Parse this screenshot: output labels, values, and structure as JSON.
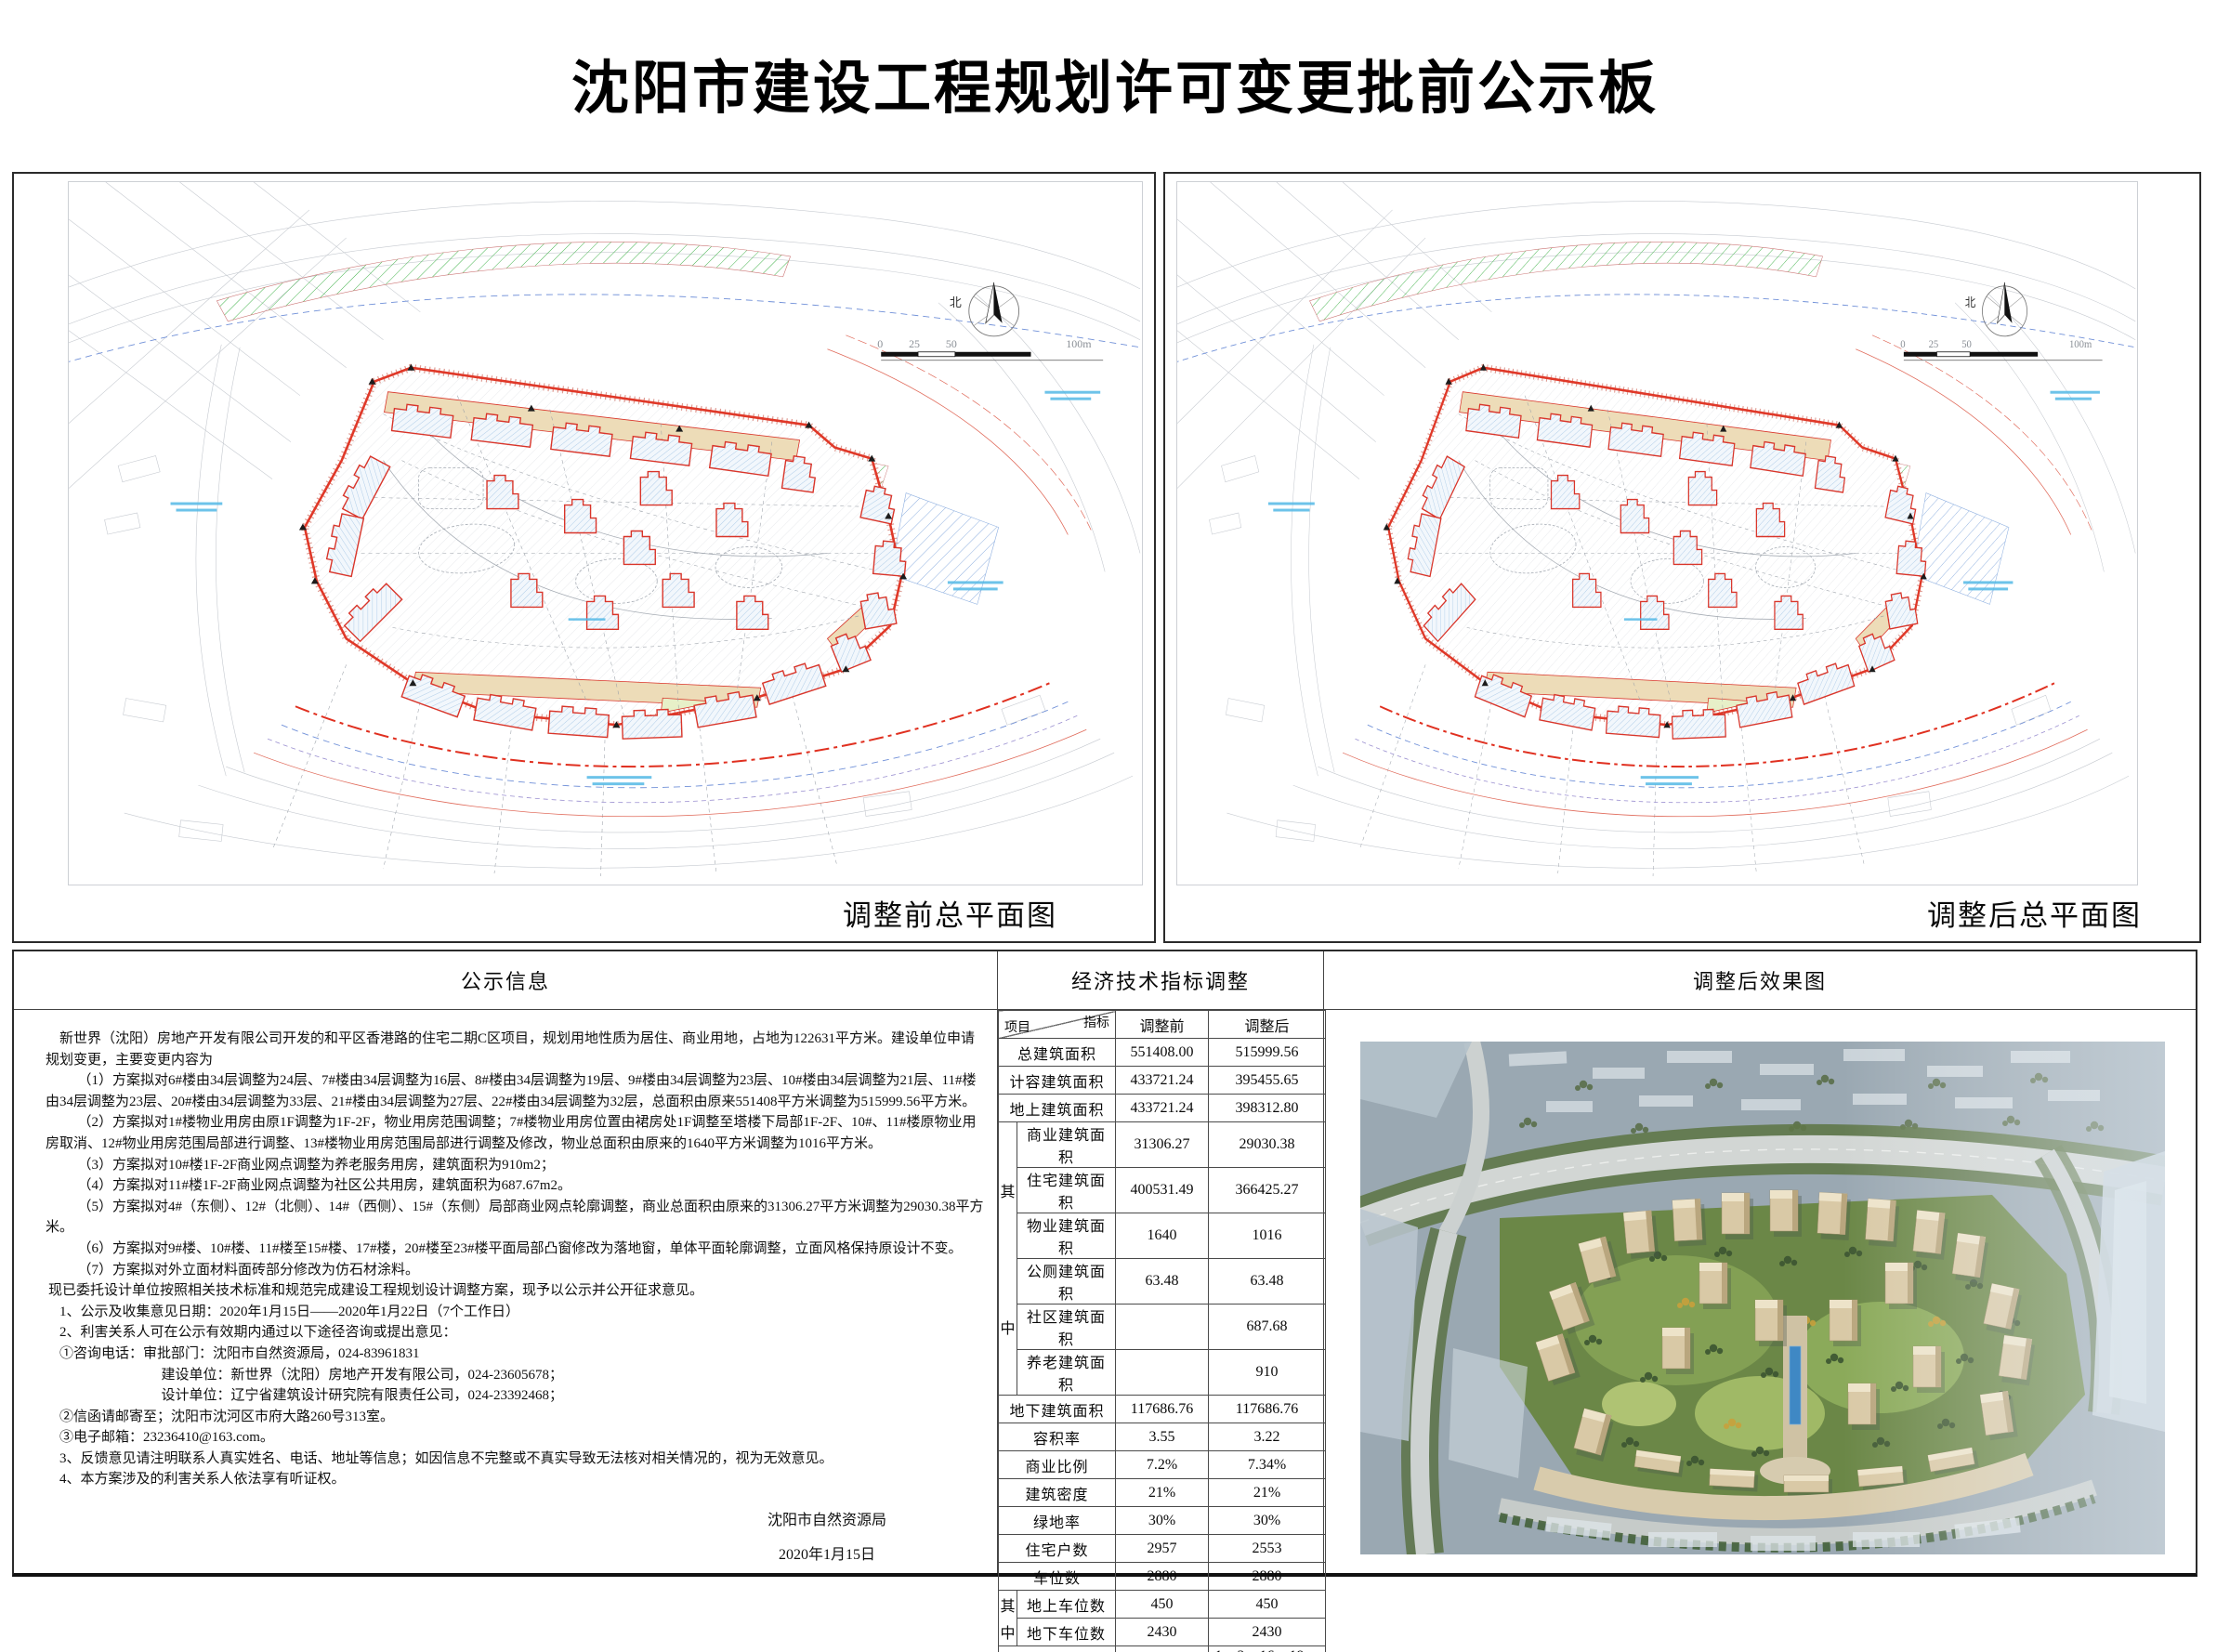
{
  "title": "沈阳市建设工程规划许可变更批前公示板",
  "plans": {
    "before_caption": "调整前总平面图",
    "after_caption": "调整后总平面图",
    "compass_label": "北",
    "scale": {
      "t0": "0",
      "t1": "25",
      "t2": "50",
      "t3": "100m"
    }
  },
  "sections": {
    "notice_header": "公示信息",
    "indicators_header": "经济技术指标调整",
    "render_header": "调整后效果图"
  },
  "notice": {
    "paragraphs": [
      "新世界（沈阳）房地产开发有限公司开发的和平区香港路的住宅二期C区项目，规划用地性质为居住、商业用地，占地为122631平方米。建设单位申请规划变更，主要变更内容为",
      "（1）方案拟对6#楼由34层调整为24层、7#楼由34层调整为16层、8#楼由34层调整为19层、9#楼由34层调整为23层、10#楼由34层调整为21层、11#楼由34层调整为23层、20#楼由34层调整为33层、21#楼由34层调整为27层、22#楼由34层调整为32层，总面积由原来551408平方米调整为515999.56平方米。",
      "（2）方案拟对1#楼物业用房由原1F调整为1F-2F，物业用房范围调整；7#楼物业用房位置由裙房处1F调整至塔楼下局部1F-2F、10#、11#楼原物业用房取消、12#物业用房范围局部进行调整、13#楼物业用房范围局部进行调整及修改，物业总面积由原来的1640平方米调整为1016平方米。",
      "（3）方案拟对10#楼1F-2F商业网点调整为养老服务用房，建筑面积为910m2；",
      "（4）方案拟对11#楼1F-2F商业网点调整为社区公共用房，建筑面积为687.67m2。",
      "（5）方案拟对4#（东侧）、12#（北侧）、14#（西侧）、15#（东侧）局部商业网点轮廓调整，商业总面积由原来的31306.27平方米调整为29030.38平方米。",
      "（6）方案拟对9#楼、10#楼、11#楼至15#楼、17#楼，20#楼至23#楼平面局部凸窗修改为落地窗，单体平面轮廓调整，立面风格保持原设计不变。",
      "（7）方案拟对外立面材料面砖部分修改为仿石材涂料。",
      "现已委托设计单位按照相关技术标准和规范完成建设工程规划设计调整方案，现予以公示并公开征求意见。",
      "1、公示及收集意见日期：2020年1月15日——2020年1月22日（7个工作日）",
      "2、利害关系人可在公示有效期内通过以下途径咨询或提出意见：",
      "①咨询电话：审批部门：沈阳市自然资源局，024-83961831",
      "建设单位：新世界（沈阳）房地产开发有限公司，024-23605678；",
      "设计单位：辽宁省建筑设计研究院有限责任公司，024-23392468；",
      "②信函请邮寄至；沈阳市沈河区市府大路260号313室。",
      "③电子邮箱：23236410@163.com。",
      "3、反馈意见请注明联系人真实姓名、电话、地址等信息；如因信息不完整或不真实导致无法核对相关情况的，视为无效意见。",
      "4、本方案涉及的利害关系人依法享有听证权。"
    ],
    "signature": {
      "org": "沈阳市自然资源局",
      "date": "2020年1月15日"
    }
  },
  "table": {
    "corner_top": "指标",
    "corner_bottom": "项目",
    "col_before": "调整前",
    "col_after": "调整后",
    "group": {
      "top": "其",
      "bottom": "中"
    },
    "rows": [
      {
        "label": "总建筑面积",
        "before": "551408.00",
        "after": "515999.56"
      },
      {
        "label": "计容建筑面积",
        "before": "433721.24",
        "after": "395455.65"
      },
      {
        "label": "地上建筑面积",
        "before": "433721.24",
        "after": "398312.80"
      },
      {
        "label": "商业建筑面积",
        "before": "31306.27",
        "after": "29030.38"
      },
      {
        "label": "住宅建筑面积",
        "before": "400531.49",
        "after": "366425.27"
      },
      {
        "label": "物业建筑面积",
        "before": "1640",
        "after": "1016"
      },
      {
        "label": "公厕建筑面积",
        "before": "63.48",
        "after": "63.48"
      },
      {
        "label": "社区建筑面积",
        "before": "",
        "after": "687.68"
      },
      {
        "label": "养老建筑面积",
        "before": "",
        "after": "910"
      },
      {
        "label": "地下建筑面积",
        "before": "117686.76",
        "after": "117686.76"
      },
      {
        "label": "容积率",
        "before": "3.55",
        "after": "3.22"
      },
      {
        "label": "商业比例",
        "before": "7.2%",
        "after": "7.34%"
      },
      {
        "label": "建筑密度",
        "before": "21%",
        "after": "21%"
      },
      {
        "label": "绿地率",
        "before": "30%",
        "after": "30%"
      },
      {
        "label": "住宅户数",
        "before": "2957",
        "after": "2553"
      },
      {
        "label": "车位数",
        "before": "2880",
        "after": "2880"
      },
      {
        "label": "地上车位数",
        "before": "450",
        "after": "450"
      },
      {
        "label": "地下车位数",
        "before": "2430",
        "after": "2430"
      },
      {
        "label": "建筑层数",
        "before": "1、2、23、30、33、34F",
        "after": "1、2、16、19、21、23、24、27、30、32、33、34F"
      }
    ],
    "colors": {
      "boundary_red": "#e03828",
      "podium_tan": "#eddcb8",
      "hatch_blue": "#a9c9e6",
      "hatch_green": "#43b34c"
    }
  }
}
